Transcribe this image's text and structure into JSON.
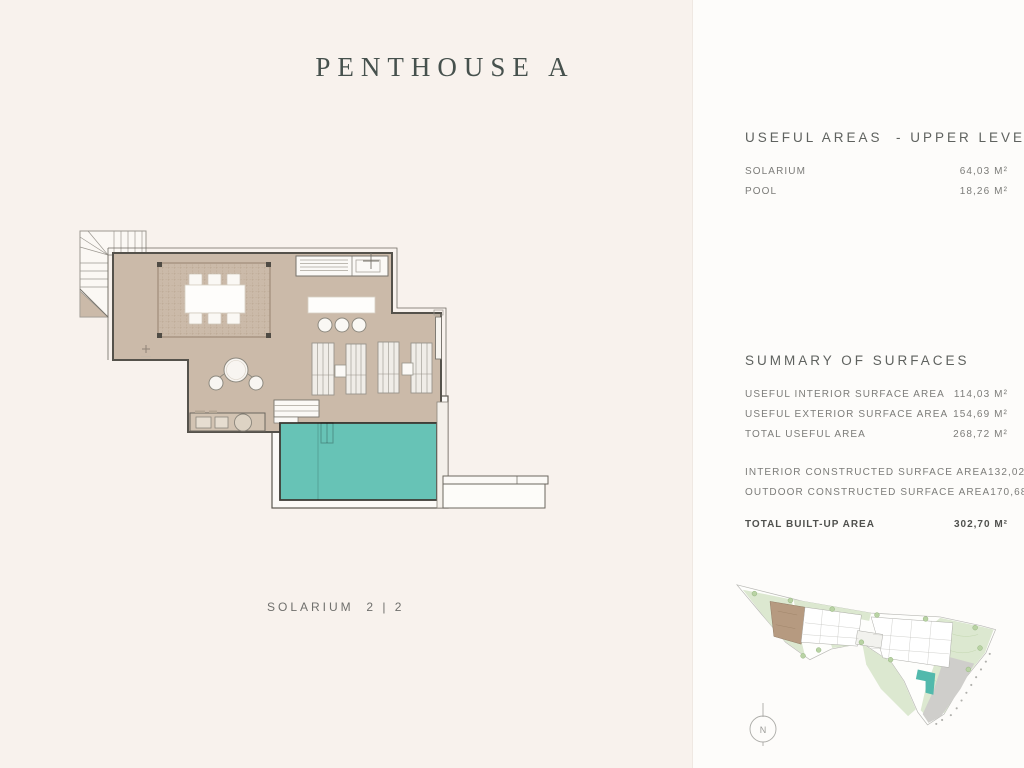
{
  "page": {
    "title": "PENTHOUSE A",
    "plan_caption": "SOLARIUM  2 | 2"
  },
  "useful_areas": {
    "heading": "USEFUL AREAS  - UPPER LEVEL",
    "rows": [
      {
        "label": "SOLARIUM",
        "value": "64,03 M²"
      },
      {
        "label": "POOL",
        "value": "18,26 M²"
      }
    ]
  },
  "summary": {
    "heading": "SUMMARY OF SURFACES",
    "rows": [
      {
        "label": "USEFUL INTERIOR SURFACE AREA",
        "value": "114,03 M²"
      },
      {
        "label": "USEFUL EXTERIOR SURFACE AREA",
        "value": "154,69 M²"
      },
      {
        "label": "TOTAL USEFUL AREA",
        "value": "268,72 M²"
      },
      {
        "label": "INTERIOR CONSTRUCTED SURFACE AREA",
        "value": "132,02 M²"
      },
      {
        "label": "OUTDOOR CONSTRUCTED SURFACE AREA",
        "value": "170,68 M²"
      }
    ],
    "total": {
      "label": "TOTAL BUILT-UP AREA",
      "value": "302,70 M²"
    }
  },
  "site_plan": {
    "compass_label": "N"
  },
  "colors": {
    "page_left_bg": "#f8f2ed",
    "page_right_bg": "#fdfcfa",
    "title_text": "#46514d",
    "heading_text": "#5f625f",
    "body_text": "#7c7c79",
    "total_text": "#50514e",
    "terrace_fill": "#cbbaa9",
    "pool_fill": "#67c3b6",
    "plan_outline": "#55524b",
    "site_green": "#dce8d0",
    "site_road": "#cfcecb",
    "highlighted_building": "#b69a80"
  }
}
